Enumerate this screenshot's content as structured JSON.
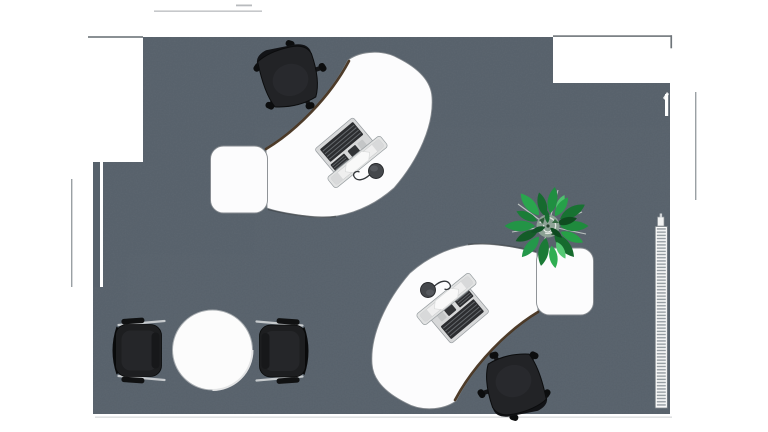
{
  "meta": {
    "title": "Office floor plan - top-down 3D render",
    "canvas": {
      "width": 768,
      "height": 432
    }
  },
  "colors": {
    "background": "#ffffff",
    "floor": "#57616b",
    "wall_line": "#6e7479",
    "exterior_line": "#9aa0a4",
    "dimension_line": "#b8bbbe",
    "bottom_edge_line": "#d9dbdc",
    "desk_top": "#fcfcfd",
    "desk_outline": "#84898e",
    "desk_edge_shadow": "#44311f",
    "office_chair_seat": "#222326",
    "office_chair_back": "#121316",
    "chair_leg": "#141517",
    "visitor_chair_seat": "#1d1e20",
    "chrome": "#c6cacd",
    "armrest_pad": "#101112",
    "table_top": "#fcfcfc",
    "table_outline": "#a6abaf",
    "keyboard_frame": "#d7d8d9",
    "keyboard_keys": "#2c2d30",
    "monitor_body": "#e2e3e3",
    "monitor_screen": "#efefef",
    "mouse": "#45484c",
    "radiator_body": "#fdfdfd",
    "radiator_fin": "#8f979c",
    "plant_core": "#8fa497",
    "plant_green_dark": "#145c28",
    "plant_green": "#1f8a3d",
    "plant_green_light": "#2fae52",
    "plant_twig": "#cdd3cf"
  },
  "objects": [
    {
      "id": "room-floor",
      "label": "Room floor (carpet)"
    },
    {
      "id": "workstation-upper",
      "label": "Curved desk workstation, upper-left"
    },
    {
      "id": "workstation-lower",
      "label": "Curved desk workstation, lower-right"
    },
    {
      "id": "office-chair",
      "label": "Black swivel office chair"
    },
    {
      "id": "meeting-table",
      "label": "Round white meeting table"
    },
    {
      "id": "visitor-chair-left",
      "label": "Visitor chair, left"
    },
    {
      "id": "visitor-chair-right",
      "label": "Visitor chair, right"
    },
    {
      "id": "plant",
      "label": "Green potted plant"
    },
    {
      "id": "radiator",
      "label": "Wall radiator, right side"
    },
    {
      "id": "keyboard",
      "label": "Keyboard on desk"
    },
    {
      "id": "monitor",
      "label": "Flat monitor on desk"
    },
    {
      "id": "mouse",
      "label": "Computer mouse on desk"
    }
  ]
}
